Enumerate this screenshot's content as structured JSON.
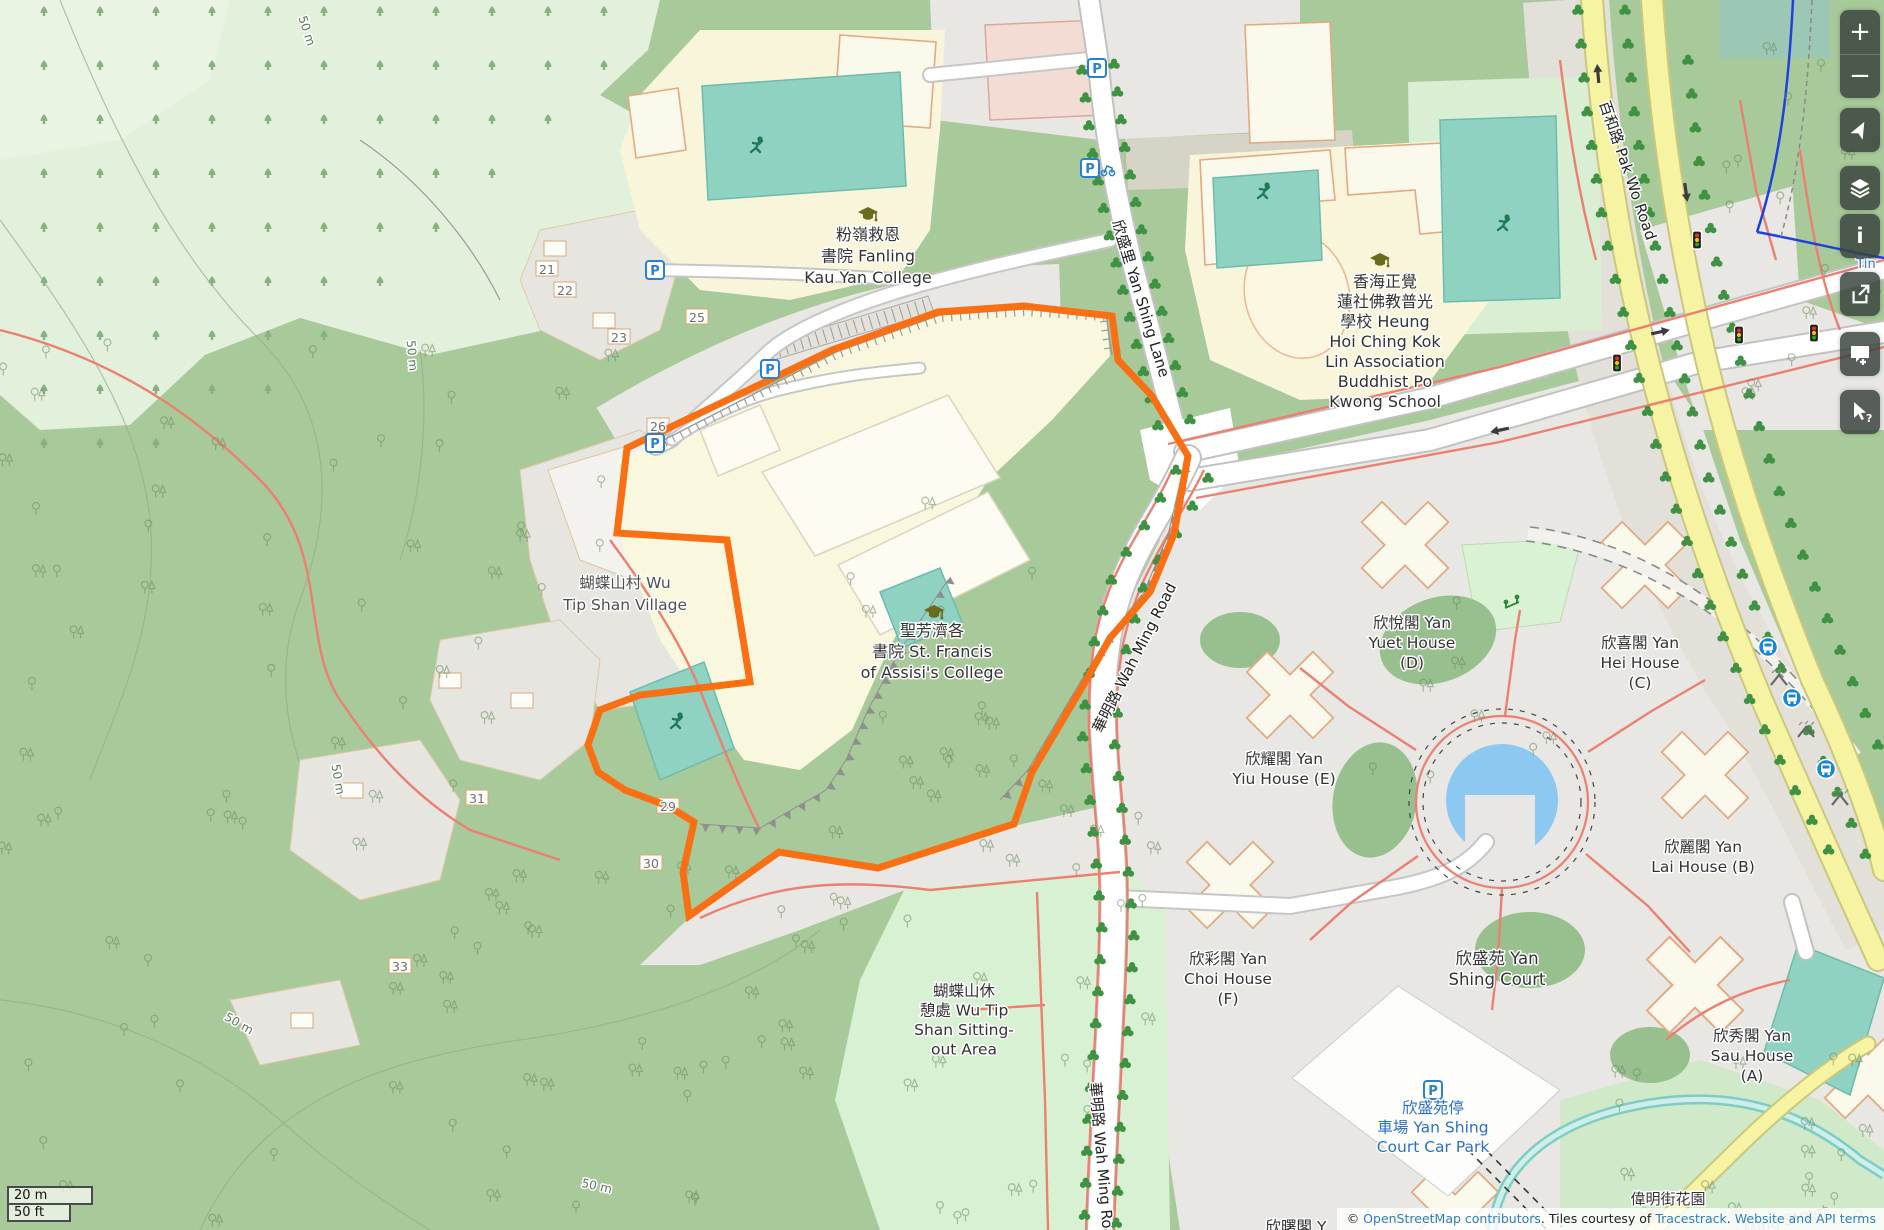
{
  "ui": {
    "sidebar": {
      "zoom_in": "+",
      "zoom_out": "−",
      "info_glyph": "i",
      "query_glyph": "?"
    },
    "scale": {
      "metric": "20 m",
      "imperial": "50 ft"
    },
    "attribution": {
      "copyright": "© ",
      "osm_link": "OpenStreetMap contributors",
      "mid": ". Tiles courtesy of ",
      "tracestrack_link": "Tracestrack",
      "sep": ". ",
      "terms_link": "Website and API terms"
    }
  },
  "map": {
    "colors": {
      "boundary_orange": "#f96f14",
      "forest": "#a8c99a",
      "plantation": "#e3f0dc",
      "park": "#d9f1d3",
      "campus": "#f8f5da",
      "urban": "#e9e7e3",
      "village": "#e7e5e0",
      "building": "#fbf8ec",
      "building_stroke": "#e2aa82",
      "road_yellow": "#f6f3a3",
      "path_red": "#ec8070",
      "water": "#8cc8f0",
      "stream": "#7fccc4",
      "pitch": "#90d2c1",
      "label_blue": "#2a70c8",
      "bus_blue": "#1786d3",
      "street_tree": "#3f9242"
    },
    "labels": [
      {
        "id": "kau-yan-college",
        "x": 868,
        "y": 240,
        "size": 16,
        "lh": 21.5,
        "color": "#333333",
        "lines": [
          "粉嶺救恩",
          "書院 Fanling",
          "Kau Yan College"
        ]
      },
      {
        "id": "buddhist-po-kwong-school",
        "x": 1385,
        "y": 287,
        "size": 16,
        "lh": 20,
        "color": "#333333",
        "lines": [
          "香海正覺",
          "蓮社佛教普光",
          "學校 Heung",
          "Hoi Ching Kok",
          "Lin Association",
          "Buddhist Po",
          "Kwong School"
        ]
      },
      {
        "id": "st-francis-college",
        "x": 932,
        "y": 636,
        "size": 16,
        "lh": 21,
        "color": "#333333",
        "lines": [
          "聖芳濟各",
          "書院 St. Francis",
          "of Assisi's College"
        ]
      },
      {
        "id": "wu-tip-shan-village",
        "x": 625,
        "y": 588,
        "size": 15.5,
        "lh": 22,
        "color": "#4f4f4f",
        "lines": [
          "蝴蝶山村 Wu",
          "Tip Shan Village"
        ]
      },
      {
        "id": "wu-tip-shan-sitting-out-area",
        "x": 964,
        "y": 996,
        "size": 15.5,
        "lh": 19.5,
        "color": "#333333",
        "lines": [
          "蝴蝶山休",
          "憩處 Wu Tip",
          "Shan Sitting-",
          "out Area"
        ]
      },
      {
        "id": "yan-yuet-house",
        "x": 1412,
        "y": 628,
        "size": 15.5,
        "lh": 20,
        "color": "#333333",
        "lines": [
          "欣悅閣 Yan",
          "Yuet House",
          "(D)"
        ]
      },
      {
        "id": "yan-hei-house",
        "x": 1640,
        "y": 648,
        "size": 15.5,
        "lh": 20,
        "color": "#333333",
        "lines": [
          "欣喜閣 Yan",
          "Hei House",
          "(C)"
        ]
      },
      {
        "id": "yan-yiu-house",
        "x": 1284,
        "y": 764,
        "size": 15.5,
        "lh": 20,
        "color": "#333333",
        "lines": [
          "欣耀閣 Yan",
          "Yiu House (E)"
        ]
      },
      {
        "id": "yan-lai-house",
        "x": 1703,
        "y": 852,
        "size": 15.5,
        "lh": 20,
        "color": "#333333",
        "lines": [
          "欣麗閣 Yan",
          "Lai House (B)"
        ]
      },
      {
        "id": "yan-choi-house",
        "x": 1228,
        "y": 964,
        "size": 15.5,
        "lh": 20,
        "color": "#333333",
        "lines": [
          "欣彩閣 Yan",
          "Choi House",
          "(F)"
        ]
      },
      {
        "id": "yan-shing-court",
        "x": 1497,
        "y": 964,
        "size": 16.5,
        "lh": 21,
        "color": "#333333",
        "lines": [
          "欣盛苑 Yan",
          "Shing Court"
        ]
      },
      {
        "id": "yan-sau-house",
        "x": 1752,
        "y": 1041,
        "size": 15.5,
        "lh": 20,
        "color": "#333333",
        "lines": [
          "欣秀閣 Yan",
          "Sau House",
          "(A)"
        ]
      },
      {
        "id": "yan-shing-court-car-park",
        "x": 1433,
        "y": 1113,
        "size": 15.5,
        "lh": 19.5,
        "color": "#2a70c8",
        "lines": [
          "欣盛苑停",
          "車場 Yan Shing",
          "Court Car Park"
        ]
      },
      {
        "id": "wai-ming-street-garden",
        "x": 1668,
        "y": 1204,
        "size": 15,
        "lh": 19,
        "color": "#333333",
        "lines": [
          "偉明街花園"
        ]
      },
      {
        "id": "partial-house-label",
        "x": 1296,
        "y": 1232,
        "size": 15.5,
        "lh": 20,
        "color": "#333333",
        "lines": [
          "欣曙閣 Y"
        ]
      },
      {
        "id": "wai-ming-street-ghost",
        "x": 1772,
        "y": 1229,
        "rot": -14,
        "size": 15,
        "color": "#9a9a9a",
        "halo": false,
        "lines": [
          "Wai Ming Street"
        ]
      },
      {
        "id": "yan-shing-lane-road",
        "x": 1136,
        "y": 300,
        "rot": 73,
        "size": 15,
        "color": "#222222",
        "lines": [
          "欣盛里 Yan Shing Lane"
        ]
      },
      {
        "id": "wah-ming-road",
        "x": 1139,
        "y": 660,
        "rot": -63,
        "size": 15,
        "color": "#222222",
        "lines": [
          "華明路 Wah Ming Road"
        ]
      },
      {
        "id": "wah-ming-road-south",
        "x": 1097,
        "y": 1165,
        "rot": 85,
        "size": 15,
        "color": "#222222",
        "lines": [
          "華明路 Wah Ming Road"
        ]
      },
      {
        "id": "pak-wo-road",
        "x": 1623,
        "y": 172,
        "rot": 71,
        "size": 15,
        "color": "#222222",
        "lines": [
          "百和路 Pak Wo Road"
        ]
      },
      {
        "id": "house-21",
        "x": 547,
        "y": 274,
        "size": 12.5,
        "color": "#6f6f6f",
        "lines": [
          "21"
        ]
      },
      {
        "id": "house-22",
        "x": 565,
        "y": 295,
        "size": 12.5,
        "color": "#6f6f6f",
        "lines": [
          "22"
        ]
      },
      {
        "id": "house-23",
        "x": 619,
        "y": 342,
        "size": 12.5,
        "color": "#6f6f6f",
        "lines": [
          "23"
        ]
      },
      {
        "id": "house-25",
        "x": 697,
        "y": 322,
        "size": 12.5,
        "color": "#6f6f6f",
        "lines": [
          "25"
        ]
      },
      {
        "id": "house-26",
        "x": 658,
        "y": 431,
        "size": 12.5,
        "color": "#6f6f6f",
        "lines": [
          "26"
        ]
      },
      {
        "id": "house-31",
        "x": 477,
        "y": 803,
        "size": 12.5,
        "color": "#6f6f6f",
        "lines": [
          "31"
        ]
      },
      {
        "id": "house-29",
        "x": 668,
        "y": 811,
        "size": 12.5,
        "color": "#6f6f6f",
        "lines": [
          "29"
        ]
      },
      {
        "id": "house-30",
        "x": 651,
        "y": 868,
        "size": 12.5,
        "color": "#6f6f6f",
        "lines": [
          "30"
        ]
      },
      {
        "id": "house-33",
        "x": 400,
        "y": 971,
        "size": 12.5,
        "color": "#6f6f6f",
        "lines": [
          "33"
        ]
      },
      {
        "id": "contour-50m-1",
        "x": 303,
        "y": 32,
        "rot": 72,
        "size": 12,
        "color": "#5c755c",
        "lines": [
          "50 m"
        ]
      },
      {
        "id": "contour-50m-2",
        "x": 408,
        "y": 356,
        "rot": 85,
        "size": 12,
        "color": "#5c755c",
        "lines": [
          "50 m"
        ]
      },
      {
        "id": "contour-50m-3",
        "x": 334,
        "y": 780,
        "rot": 80,
        "size": 12,
        "color": "#5c755c",
        "lines": [
          "50 m"
        ]
      },
      {
        "id": "contour-50m-4",
        "x": 237,
        "y": 1027,
        "rot": 30,
        "size": 12,
        "color": "#5c755c",
        "lines": [
          "50 m"
        ]
      },
      {
        "id": "contour-50m-5",
        "x": 596,
        "y": 1190,
        "rot": 12,
        "size": 12,
        "color": "#5c755c",
        "lines": [
          "50 m"
        ]
      },
      {
        "id": "tin-label",
        "x": 1866,
        "y": 268,
        "size": 13,
        "color": "#2a70c8",
        "lines": [
          "Tin"
        ]
      }
    ],
    "icons": [
      {
        "type": "school-icon",
        "x": 868,
        "y": 214
      },
      {
        "type": "school-icon",
        "x": 1380,
        "y": 260
      },
      {
        "type": "school-icon",
        "x": 934,
        "y": 612
      },
      {
        "type": "parking-icon",
        "x": 655,
        "y": 270
      },
      {
        "type": "parking-icon",
        "x": 770,
        "y": 369
      },
      {
        "type": "parking-icon",
        "x": 655,
        "y": 443
      },
      {
        "type": "parking-icon",
        "x": 1097,
        "y": 68
      },
      {
        "type": "parking-scooter-icon",
        "x": 1096,
        "y": 168
      },
      {
        "type": "car-park-icon",
        "x": 1433,
        "y": 1090
      },
      {
        "type": "bus-stop-icon",
        "x": 1768,
        "y": 647
      },
      {
        "type": "bus-stop-icon",
        "x": 1792,
        "y": 698
      },
      {
        "type": "bus-stop-icon",
        "x": 1826,
        "y": 769
      },
      {
        "type": "bus-shelter-icon",
        "x": 1779,
        "y": 680
      },
      {
        "type": "bus-shelter-icon",
        "x": 1806,
        "y": 732
      },
      {
        "type": "bus-shelter-icon",
        "x": 1840,
        "y": 800
      },
      {
        "type": "traffic-signal-icon",
        "x": 1697,
        "y": 240
      },
      {
        "type": "traffic-signal-icon",
        "x": 1617,
        "y": 363
      },
      {
        "type": "traffic-signal-icon",
        "x": 1739,
        "y": 335
      },
      {
        "type": "traffic-signal-icon",
        "x": 1814,
        "y": 333
      },
      {
        "type": "pitch-runner-icon",
        "x": 758,
        "y": 146
      },
      {
        "type": "pitch-runner-icon",
        "x": 1265,
        "y": 192
      },
      {
        "type": "pitch-runner-icon",
        "x": 1505,
        "y": 224
      },
      {
        "type": "pitch-runner-icon",
        "x": 678,
        "y": 722
      },
      {
        "type": "playground-icon",
        "x": 1512,
        "y": 604
      },
      {
        "type": "oneway-arrow",
        "x": 1598,
        "y": 74,
        "rot": -95
      },
      {
        "type": "oneway-arrow",
        "x": 1686,
        "y": 192,
        "rot": 82
      },
      {
        "type": "oneway-arrow",
        "x": 1660,
        "y": 332,
        "rot": -12
      },
      {
        "type": "oneway-arrow",
        "x": 1500,
        "y": 430,
        "rot": 168
      }
    ]
  }
}
